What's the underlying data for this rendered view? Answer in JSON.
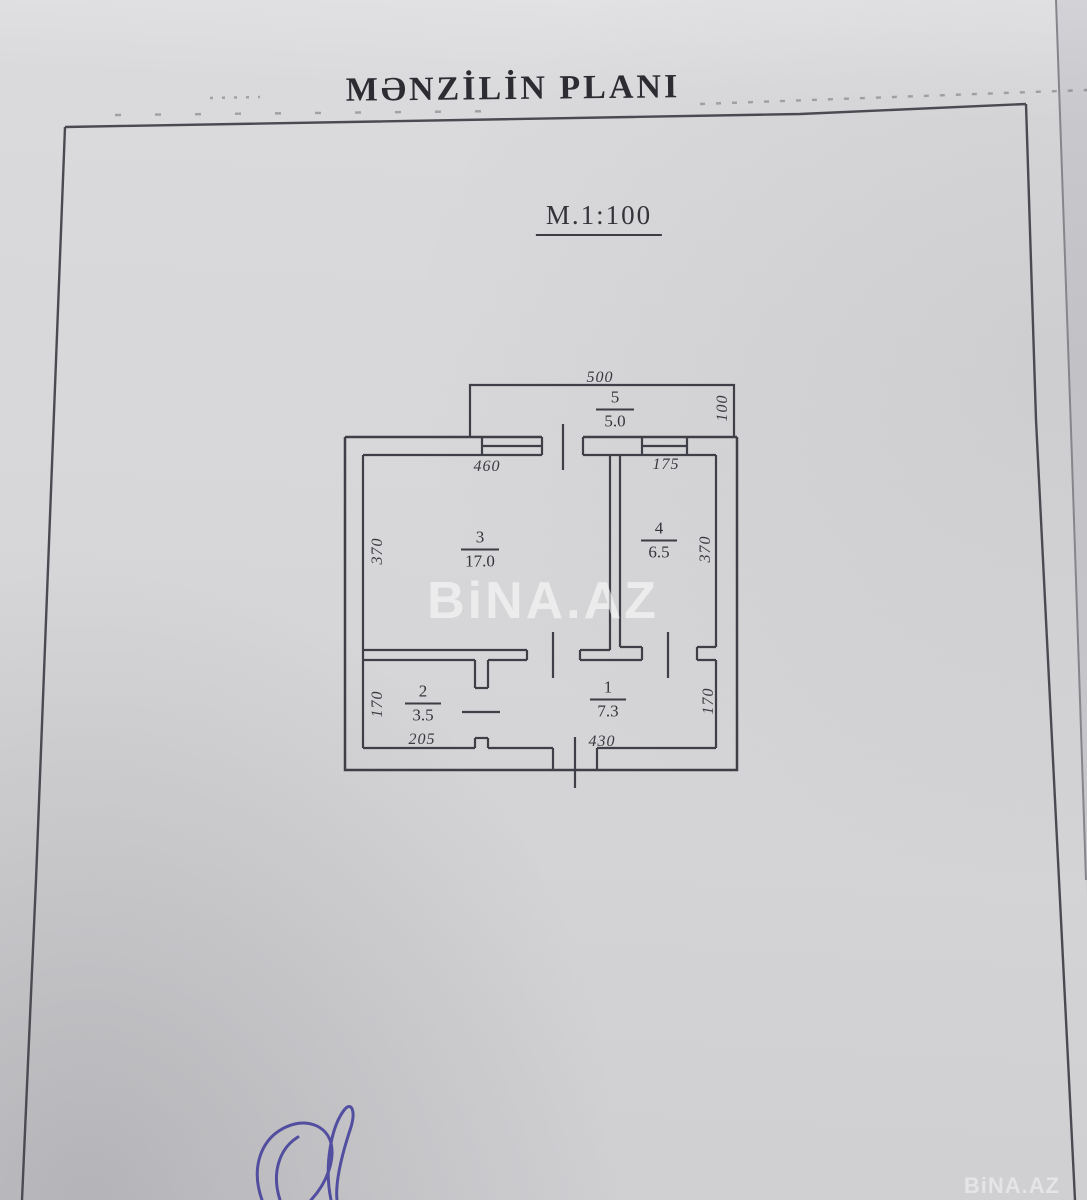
{
  "page": {
    "title": "MƏNZİLİN PLANI",
    "scale_label": "M.1:100",
    "watermark": "BiNA.AZ",
    "watermark_small": "BiNA.AZ"
  },
  "plan": {
    "rooms": {
      "r5": {
        "num": "5",
        "area": "5.0"
      },
      "r3": {
        "num": "3",
        "area": "17.0"
      },
      "r4": {
        "num": "4",
        "area": "6.5"
      },
      "r2": {
        "num": "2",
        "area": "3.5"
      },
      "r1": {
        "num": "1",
        "area": "7.3"
      }
    },
    "dims": {
      "d500": "500",
      "d100": "100",
      "d460": "460",
      "d175": "175",
      "d370_left": "370",
      "d370_right": "370",
      "d170_left": "170",
      "d170_right": "170",
      "d205": "205",
      "d430": "430"
    }
  }
}
